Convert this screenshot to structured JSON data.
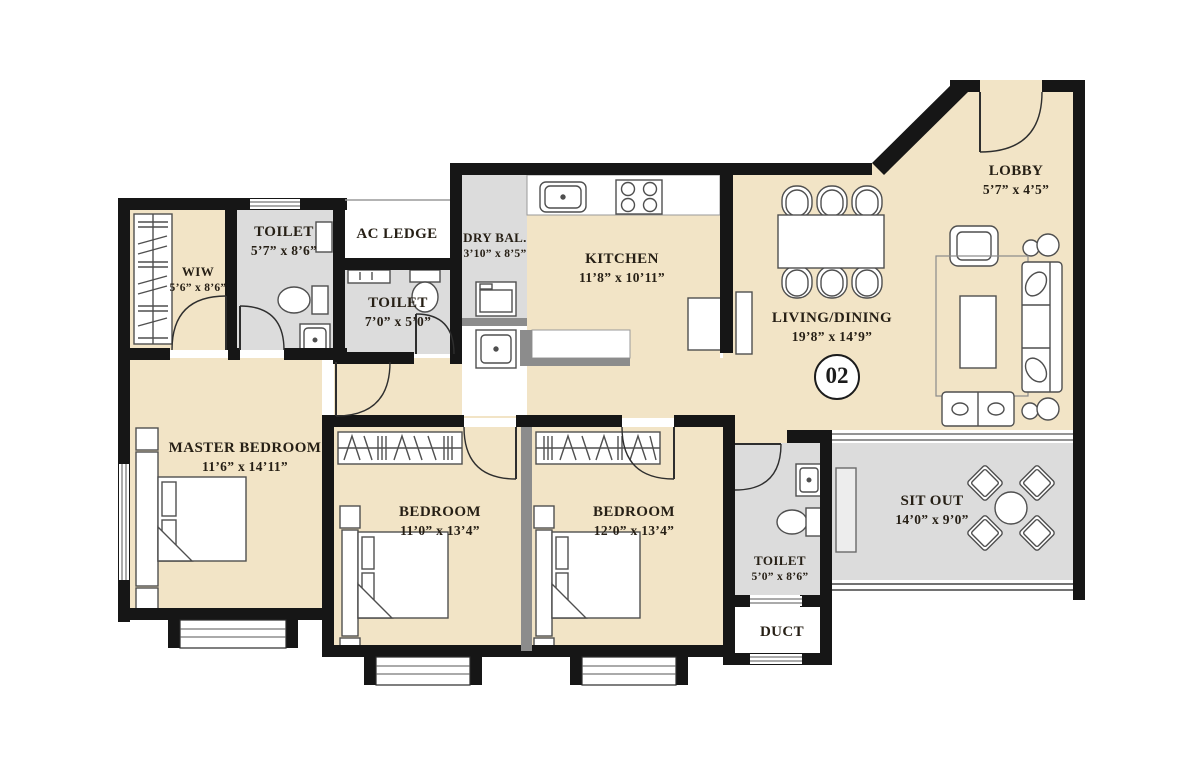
{
  "plan": {
    "unit_number": "02",
    "rooms": [
      {
        "key": "lobby",
        "name": "LOBBY",
        "dims": "5’7” x 4’5”"
      },
      {
        "key": "living_dining",
        "name": "LIVING/DINING",
        "dims": "19’8” x 14’9”"
      },
      {
        "key": "kitchen",
        "name": "KITCHEN",
        "dims": "11’8” x 10’11”"
      },
      {
        "key": "dry_balcony",
        "name": "DRY BAL.",
        "dims": "3’10” x 8’5”"
      },
      {
        "key": "ac_ledge",
        "name": "AC LEDGE",
        "dims": ""
      },
      {
        "key": "toilet_master",
        "name": "TOILET",
        "dims": "5’7” x 8’6”"
      },
      {
        "key": "toilet_common_upper",
        "name": "TOILET",
        "dims": "7’0” x 5’0”"
      },
      {
        "key": "wiw",
        "name": "WIW",
        "dims": "5’6” x 8’6”"
      },
      {
        "key": "master_bedroom",
        "name": "MASTER BEDROOM",
        "dims": "11’6” x 14’11”"
      },
      {
        "key": "bedroom_2",
        "name": "BEDROOM",
        "dims": "11’0” x 13’4”"
      },
      {
        "key": "bedroom_3",
        "name": "BEDROOM",
        "dims": "12’0” x 13’4”"
      },
      {
        "key": "toilet_common_lower",
        "name": "TOILET",
        "dims": "5’0” x 8’6”"
      },
      {
        "key": "duct",
        "name": "DUCT",
        "dims": ""
      },
      {
        "key": "sit_out",
        "name": "SIT OUT",
        "dims": "14’0” x 9’0”"
      }
    ],
    "colors": {
      "floor_beige": "#f2e4c6",
      "wet_floor_gray": "#dcdcdc",
      "wall_black": "#161616",
      "half_wall_gray": "#8c8c8c",
      "furniture_stroke": "#4f4f4f"
    }
  }
}
